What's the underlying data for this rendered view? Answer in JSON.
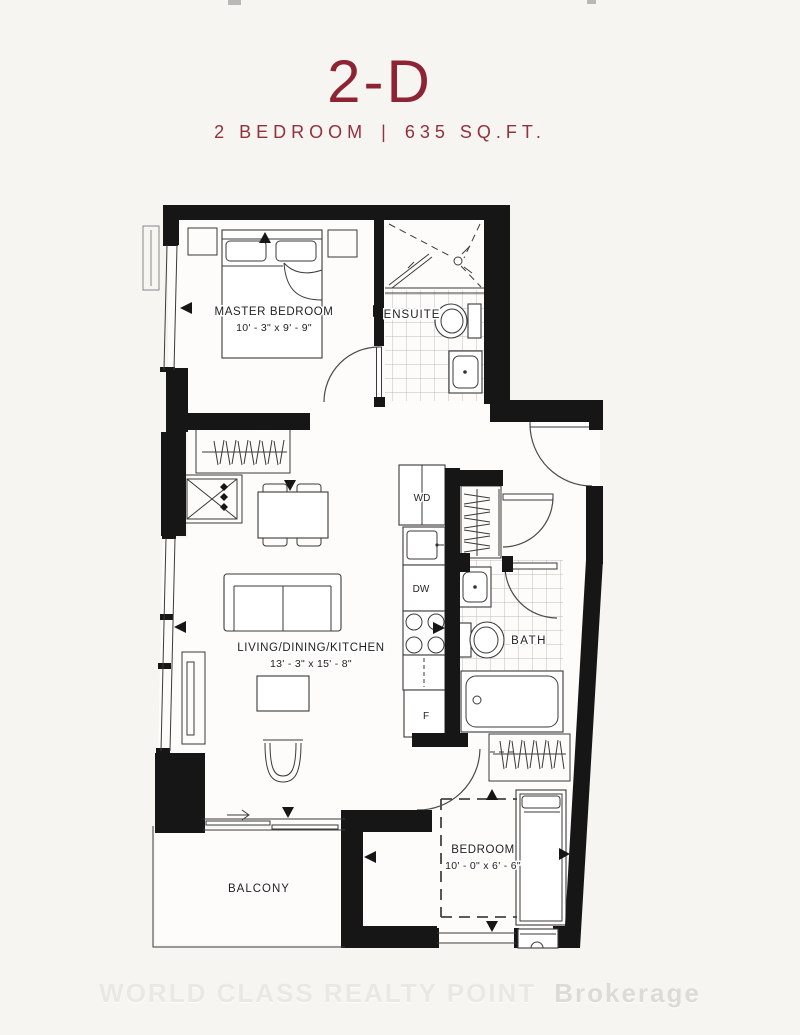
{
  "header": {
    "unit_code": "2-D",
    "bedrooms": "2 BEDROOM",
    "separator": "|",
    "area": "635 SQ.FT."
  },
  "rooms": {
    "master_bedroom": {
      "name": "MASTER BEDROOM",
      "dims": "10' - 3\" x 9' - 9\""
    },
    "ensuite": {
      "name": "ENSUITE"
    },
    "living_dining_kitchen": {
      "name": "LIVING/DINING/KITCHEN",
      "dims": "13' - 3\" x 15' - 8\""
    },
    "bath": {
      "name": "BATH"
    },
    "bedroom": {
      "name": "BEDROOM",
      "dims": "10' - 0\" x 6' - 6\""
    },
    "balcony": {
      "name": "BALCONY"
    }
  },
  "appliances": {
    "washer_dryer": "WD",
    "dishwasher": "DW",
    "fridge": "F"
  },
  "watermark": {
    "brand": "WORLD CLASS REALTY POINT",
    "suffix": "Brokerage"
  },
  "colors": {
    "accent": "#8e2433",
    "wall": "#161616",
    "line": "#3a3a3a",
    "tile": "#a8a8a8",
    "background": "#f6f5f2",
    "watermark": "#e9e8e4"
  }
}
